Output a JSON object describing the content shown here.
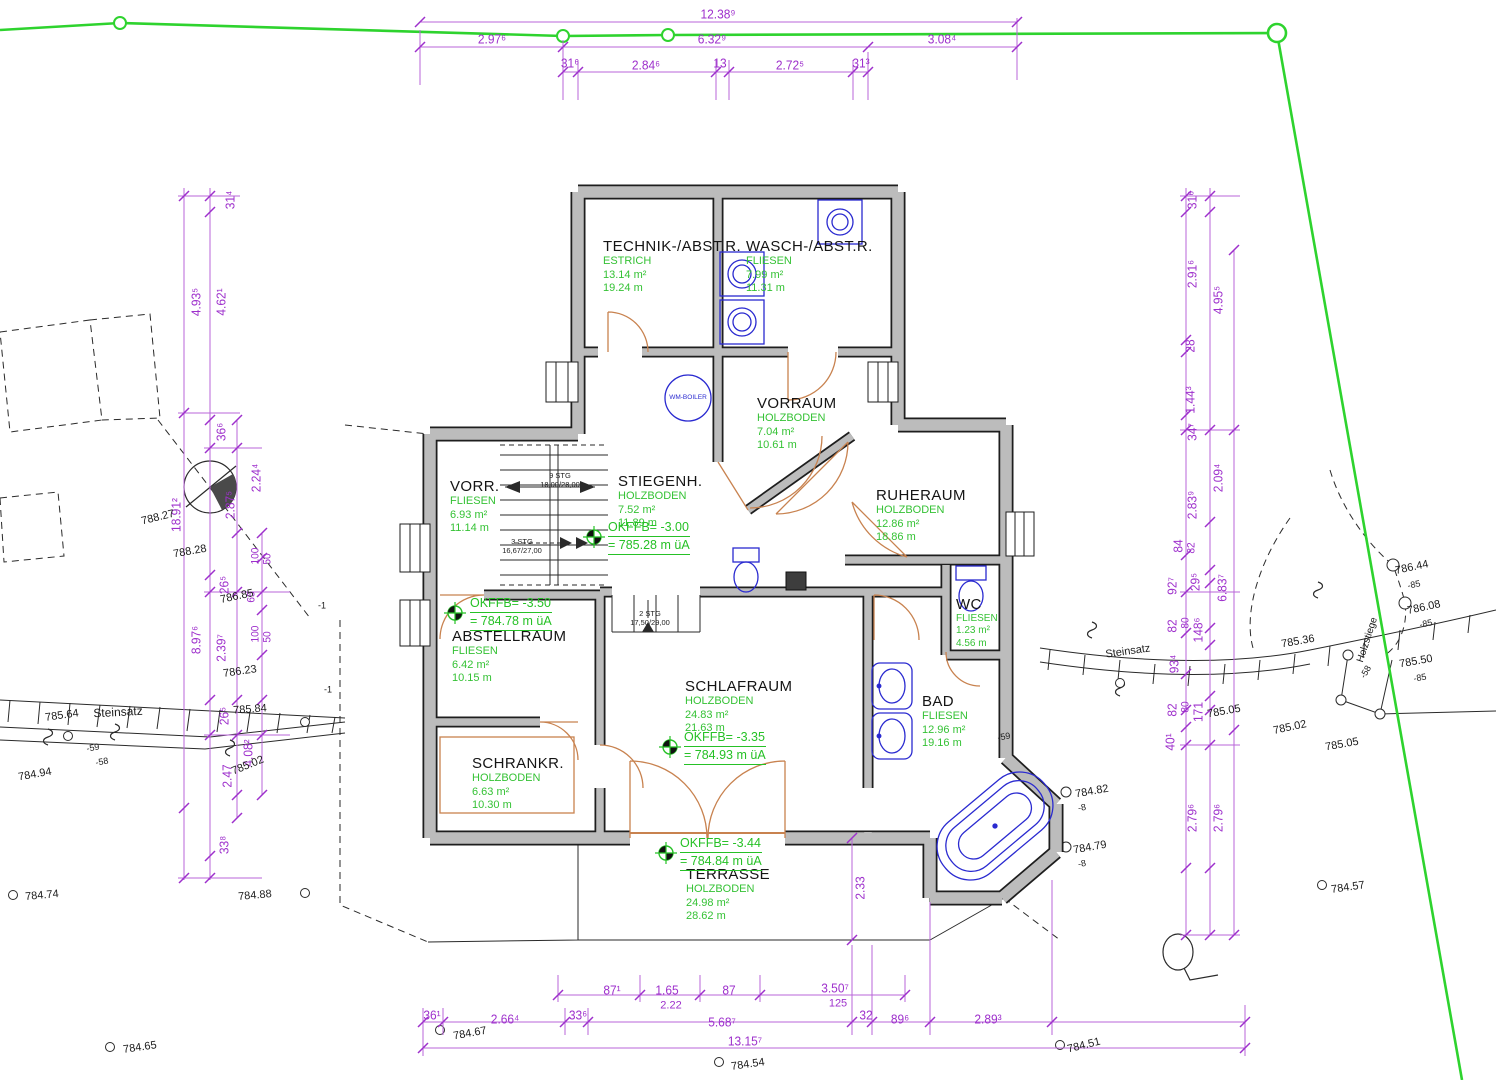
{
  "colors": {
    "boundary_green": "#2ed32e",
    "dimension_magenta": "#9e30cc",
    "wall_gray": "#bcbcbc",
    "room_green": "#35c235",
    "fixture_blue": "#2a2ad0",
    "door_orange": "#c8824f"
  },
  "top_dims": {
    "total": "12.38⁹",
    "segments": [
      "2.97⁶",
      "6.32⁹",
      "3.08⁴"
    ],
    "subsegments": [
      "31⁶",
      "2.84⁶",
      "13",
      "2.72⁵",
      "31³"
    ]
  },
  "left_dims": [
    "31⁴",
    "4.93⁵",
    "4.62¹",
    "36⁶",
    "2.24⁴",
    "2.87⁵",
    "18.91²",
    "100",
    "50",
    "26⁵",
    "65",
    "8.97⁶",
    "2.39⁷",
    "100",
    "50",
    "26⁵",
    "4.08²",
    "2.47",
    "33⁸"
  ],
  "right_dims": [
    "31⁶",
    "2.91⁶",
    "4.95⁵",
    "28",
    "1.44³",
    "34⁷",
    "2.09⁴",
    "2.83⁹",
    "84",
    "82",
    "92⁷",
    "29⁵",
    "6.83⁷",
    "82",
    "80",
    "148⁶",
    "93⁴",
    "82",
    "80",
    "171",
    "40¹",
    "2.79⁶",
    "2.79⁶"
  ],
  "bottom_dims": {
    "row1": [
      "87¹",
      "1.65",
      "87",
      "3.50⁷"
    ],
    "row1_sub": [
      "2.22",
      "125"
    ],
    "row2": [
      "36¹",
      "2.66⁴",
      "33⁶",
      "5.68⁷",
      "32",
      "89⁶",
      "2.89³"
    ],
    "total": "13.15⁷",
    "terrace_height": "2.33"
  },
  "rooms": [
    {
      "name": "TECHNIK-/ABST.R.",
      "floor": "ESTRICH",
      "area": "13.14 m²",
      "perimeter": "19.24 m"
    },
    {
      "name": "WASCH-/ABST.R.",
      "floor": "FLIESEN",
      "area": "7.99 m²",
      "perimeter": "11.31 m"
    },
    {
      "name": "VORRAUM",
      "floor": "HOLZBODEN",
      "area": "7.04 m²",
      "perimeter": "10.61 m"
    },
    {
      "name": "RUHERAUM",
      "floor": "HOLZBODEN",
      "area": "12.86 m²",
      "perimeter": "18.86 m"
    },
    {
      "name": "STIEGENH.",
      "floor": "HOLZBODEN",
      "area": "7.52 m²",
      "perimeter": "11.89 m"
    },
    {
      "name": "VORR.",
      "floor": "FLIESEN",
      "area": "6.93 m²",
      "perimeter": "11.14 m"
    },
    {
      "name": "ABSTELLRAUM",
      "floor": "FLIESEN",
      "area": "6.42 m²",
      "perimeter": "10.15 m"
    },
    {
      "name": "SCHLAFRAUM",
      "floor": "HOLZBODEN",
      "area": "24.83 m²",
      "perimeter": "21.63 m"
    },
    {
      "name": "BAD",
      "floor": "FLIESEN",
      "area": "12.96 m²",
      "perimeter": "19.16 m"
    },
    {
      "name": "WC",
      "floor": "FLIESEN",
      "area": "1.23 m²",
      "perimeter": "4.56 m"
    },
    {
      "name": "SCHRANKR.",
      "floor": "HOLZBODEN",
      "area": "6.63 m²",
      "perimeter": "10.30 m"
    },
    {
      "name": "TERRASSE",
      "floor": "HOLZBODEN",
      "area": "24.98 m²",
      "perimeter": "28.62 m"
    }
  ],
  "levels": [
    {
      "okffb": "OKFFB= -3.00",
      "abs": "= 785.28 m üA"
    },
    {
      "okffb": "OKFFB= -3.50",
      "abs": "= 784.78 m üA"
    },
    {
      "okffb": "OKFFB= -3.35",
      "abs": "= 784.93 m üA"
    },
    {
      "okffb": "OKFFB= -3.44",
      "abs": "= 784.84 m üA"
    }
  ],
  "stairs": [
    {
      "line1": "9 STG",
      "line2": "18,00/28,00"
    },
    {
      "line1": "3 STG",
      "line2": "16,67/27,00"
    },
    {
      "line1": "2 STG",
      "line2": "17,50/29,00"
    }
  ],
  "equipment": {
    "wm_boiler": "WM-BOILER"
  },
  "site": {
    "steinsatz_left": "Steinsatz",
    "steinsatz_right": "Steinsatz",
    "holzstiege": "Holzstiege"
  },
  "spots": [
    "788.27",
    "788.28",
    "786.85",
    "786.23",
    "785.84",
    "785.64",
    "784.94",
    "-59",
    "-58",
    "784.74",
    "784.88",
    "785.02",
    "-1",
    "-1",
    "785.36",
    "786.44",
    "-85",
    "786.08",
    "-85",
    "785.50",
    "-85",
    "-58",
    "785.02",
    "785.05",
    "785.05",
    "784.82",
    "-8",
    "784.79",
    "-8",
    "784.57",
    "784.65",
    "784.67",
    "784.54",
    "784.51",
    "-59"
  ]
}
